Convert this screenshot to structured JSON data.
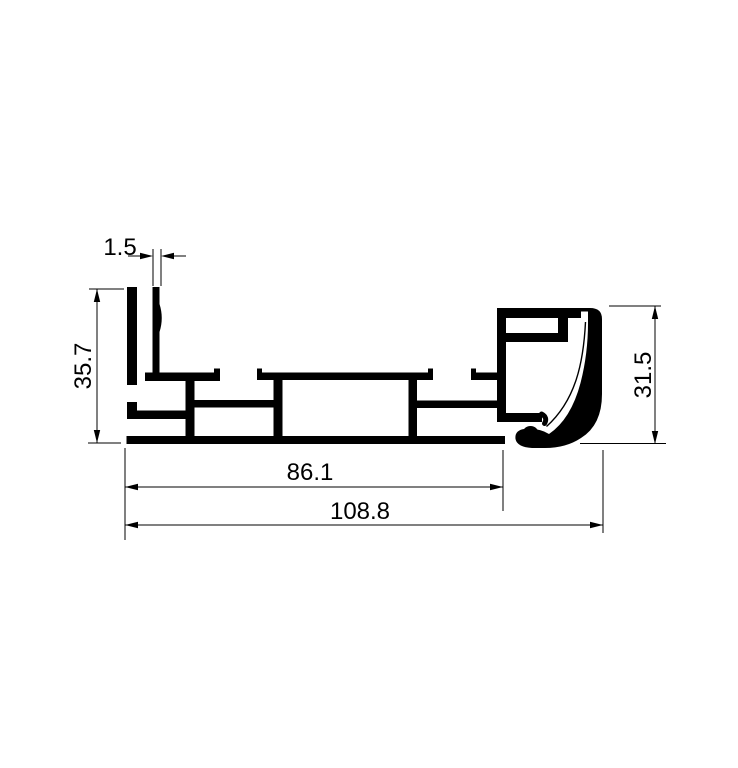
{
  "meta": {
    "background_color": "#ffffff",
    "line_color": "#000000",
    "drawing_kind": "aluminum-extrusion-profile-cross-section"
  },
  "drawing": {
    "dimensions": {
      "fin_thickness": "1.5",
      "left_height": "35.7",
      "right_height": "31.5",
      "inner_width": "86.1",
      "overall_width": "108.8"
    }
  }
}
